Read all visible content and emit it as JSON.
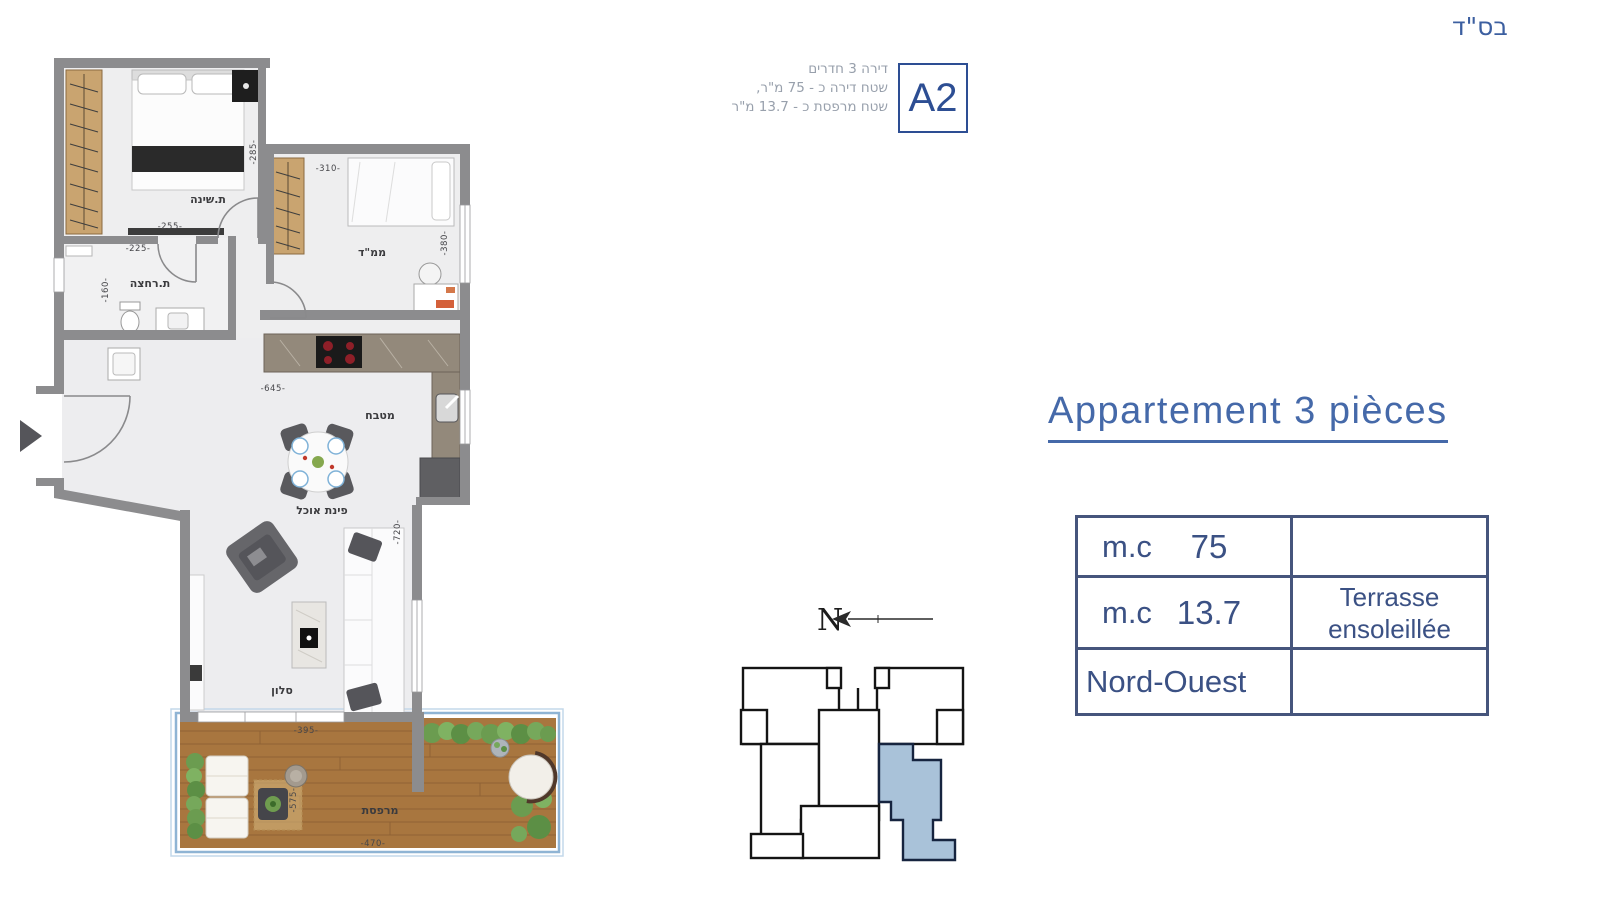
{
  "page": {
    "bsd": "בס\"ד"
  },
  "unit_card": {
    "code": "A2",
    "info_lines": [
      "דירה 3 חדרים",
      "שטח דירה כ - 75 מ\"ר,",
      "שטח מרפסת כ - 13.7 מ\"ר"
    ]
  },
  "title": {
    "text": "Appartement 3 pièces"
  },
  "info_table": {
    "rows": [
      {
        "label": "m.c",
        "value": "75",
        "note1": "",
        "note2": ""
      },
      {
        "label": "m.c",
        "value": "13.7",
        "note1": "Terrasse",
        "note2": "ensoleillée"
      },
      {
        "label": "Nord-Ouest",
        "value": "",
        "note1": "",
        "note2": ""
      }
    ]
  },
  "compass": {
    "north": "N"
  },
  "floorplan": {
    "rooms": {
      "bedroom": "ת.שינה",
      "safe_room": "ממ\"ד",
      "bathroom": "ת.רחצה",
      "kitchen": "מטבח",
      "dining": "פינת אוכל",
      "living": "סלון",
      "balcony": "מרפסת"
    },
    "dims": {
      "bedroom_w": "-255-",
      "hall_h": "-285-",
      "safe_room_w": "-310-",
      "safe_room_h": "-380-",
      "bathroom_w": "-225-",
      "bathroom_h": "-160-",
      "kitchen_w": "-645-",
      "living_h": "-720-",
      "living_w": "-395-",
      "balcony_h": "-575-",
      "balcony_w": "-470-"
    }
  },
  "colors": {
    "accent_blue": "#3c5fa0",
    "table_border": "#46557c",
    "highlight_unit": "#a9c2d9",
    "wall_gray": "#8c8c8e",
    "wood": "#c9a470",
    "deck": "#a8763f",
    "hedge_green": "#6b9c50"
  }
}
